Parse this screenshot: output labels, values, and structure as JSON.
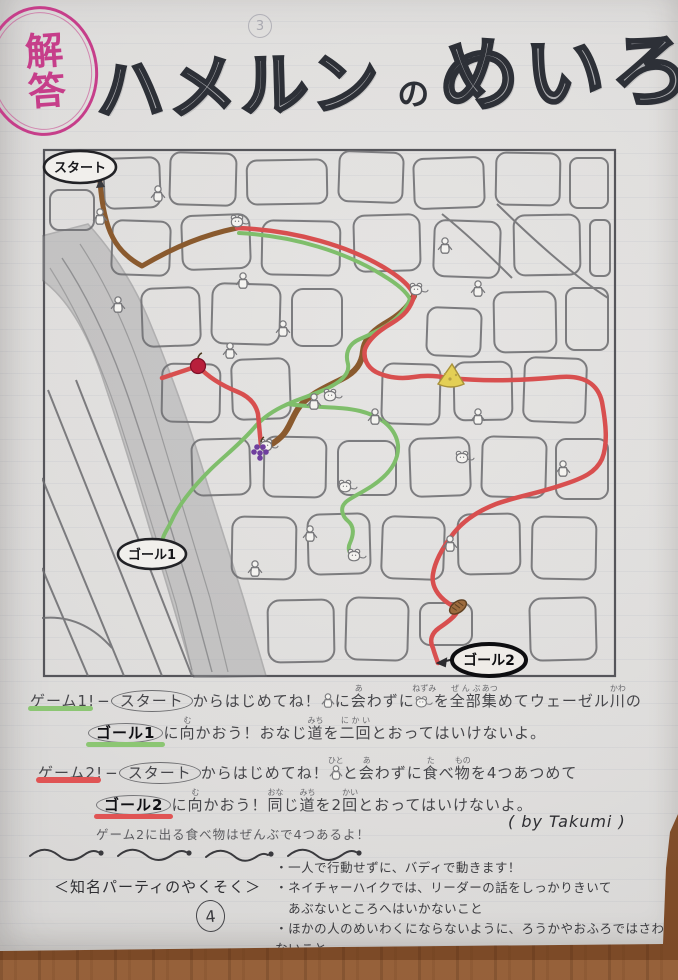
{
  "stamp": {
    "text": "解答",
    "color": "#c63e8a"
  },
  "title": {
    "part1": "ハメルン",
    "particle": "の",
    "part2": "めいろ"
  },
  "faint_page_mark": "3",
  "map": {
    "start_label": "スタート",
    "goal1_label": "ゴール1",
    "goal2_label": "ゴール2",
    "items": [
      {
        "name": "apple",
        "color": "#b81f3c"
      },
      {
        "name": "cheese",
        "color": "#e3cf55"
      },
      {
        "name": "grapes",
        "color": "#6f3f9e"
      },
      {
        "name": "bread",
        "color": "#9c6b3e"
      }
    ],
    "routes": [
      {
        "name": "start-route",
        "color": "#8a5a2e"
      },
      {
        "name": "game1-route",
        "color": "#7fbe6b"
      },
      {
        "name": "game2-route",
        "color": "#d84f4f"
      }
    ]
  },
  "game1": {
    "segments": [
      {
        "text": "ゲーム1!",
        "style": "game-label"
      },
      {
        "text": "−"
      },
      {
        "text": "スタート",
        "style": "oval"
      },
      {
        "text": "からはじめてね！"
      },
      {
        "icon": "person"
      },
      {
        "text": "に"
      },
      {
        "text": "会",
        "ruby": "あ"
      },
      {
        "text": "わずに"
      },
      {
        "icon": "mouse",
        "ruby": "ねずみ"
      },
      {
        "text": "を"
      },
      {
        "text": "全部",
        "ruby": "ぜんぶ"
      },
      {
        "text": "集",
        "ruby": "あつ"
      },
      {
        "text": "めてウェーゼル"
      },
      {
        "text": "川",
        "ruby": "かわ"
      },
      {
        "text": "の"
      },
      {
        "br": true
      },
      {
        "indent": true
      },
      {
        "text": "ゴール1",
        "style": "goal1"
      },
      {
        "text": "に"
      },
      {
        "text": "向",
        "ruby": "む"
      },
      {
        "text": "かおう！おなじ"
      },
      {
        "text": "道",
        "ruby": "みち"
      },
      {
        "text": "を"
      },
      {
        "text": "二回",
        "ruby": "にかい"
      },
      {
        "text": "とおってはいけないよ。"
      }
    ]
  },
  "game2": {
    "segments": [
      {
        "text": "ゲーム2!",
        "style": "game-label"
      },
      {
        "text": "−"
      },
      {
        "text": "スタート",
        "style": "oval"
      },
      {
        "text": "からはじめてね！"
      },
      {
        "icon": "person",
        "ruby": "ひと"
      },
      {
        "text": "と"
      },
      {
        "text": "会",
        "ruby": "あ"
      },
      {
        "text": "わずに"
      },
      {
        "text": "食",
        "ruby": "た"
      },
      {
        "text": "べ"
      },
      {
        "text": "物",
        "ruby": "もの"
      },
      {
        "text": "を4つあつめて"
      },
      {
        "br": true
      },
      {
        "indent": true
      },
      {
        "text": "ゴール2",
        "style": "goal2"
      },
      {
        "text": "に"
      },
      {
        "text": "向",
        "ruby": "む"
      },
      {
        "text": "かおう！"
      },
      {
        "text": "同",
        "ruby": "おな"
      },
      {
        "text": "じ"
      },
      {
        "text": "道",
        "ruby": "みち"
      },
      {
        "text": "を2"
      },
      {
        "text": "回",
        "ruby": "かい"
      },
      {
        "text": "とおってはいけないよ。"
      }
    ]
  },
  "note": "ゲーム2に出る食べ物はぜんぶで4つあるよ！",
  "byline": "( by Takumi )",
  "rules": {
    "heading": "＜知名パーティのやくそく＞",
    "bullets": [
      {
        "text": "・一人で行動せずに、バディで動きます！"
      },
      {
        "text": "・ネイチャーハイクでは、リーダーの話をしっかりきいて"
      },
      {
        "text": "あぶないところへはいかないこと",
        "indent": true
      },
      {
        "text": "・ほかの人のめいわくにならないように、ろうかやおふろではさわがないこと"
      },
      {
        "text": "・じぶんのゴミはできるだけもちかえります！"
      }
    ]
  },
  "page_number": "4"
}
